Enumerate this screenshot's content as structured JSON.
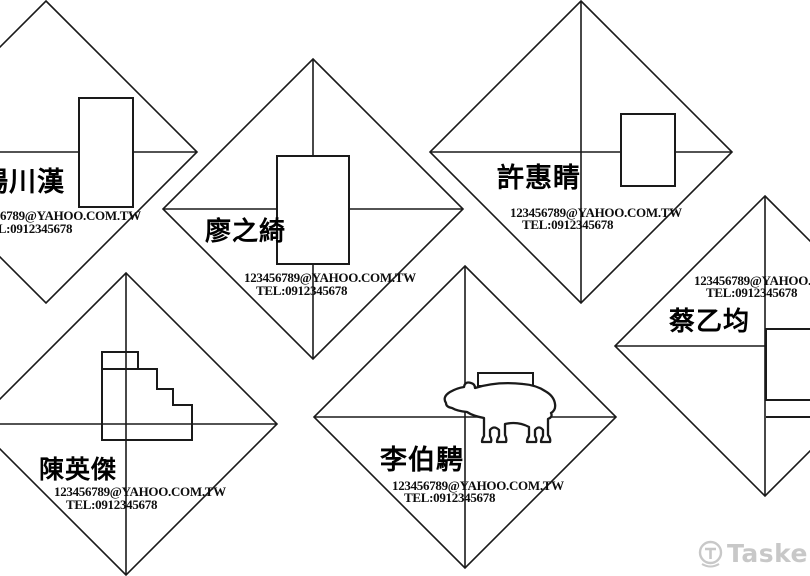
{
  "colors": {
    "line": "#1a1a1a",
    "text": "#000000",
    "watermark_gray": "#c8c8c8"
  },
  "watermark": {
    "brand": "Tasker"
  },
  "cards": [
    {
      "name": "楊川漢",
      "email": "123456789@YAHOO.COM.TW",
      "tel": "TEL:0912345678",
      "logo": "vertical-rectangle-logo"
    },
    {
      "name": "廖之綺",
      "email": "123456789@YAHOO.COM.TW",
      "tel": "TEL:0912345678",
      "logo": "vertical-rectangle-logo"
    },
    {
      "name": "許惠睛",
      "email": "123456789@YAHOO.COM.TW",
      "tel": "TEL:0912345678",
      "logo": "vertical-rectangle-logo"
    },
    {
      "name": "陳英傑",
      "email": "123456789@YAHOO.COM.TW",
      "tel": "TEL:0912345678",
      "logo": "staircase-logo"
    },
    {
      "name": "李伯騁",
      "email": "123456789@YAHOO.COM.TW",
      "tel": "TEL:0912345678",
      "logo": "bear-logo"
    },
    {
      "name": "蔡乙均",
      "email": "123456789@YAHOO.COM.TW",
      "tel": "TEL:0912345678",
      "logo": "rectangle-logo-clipped"
    }
  ]
}
